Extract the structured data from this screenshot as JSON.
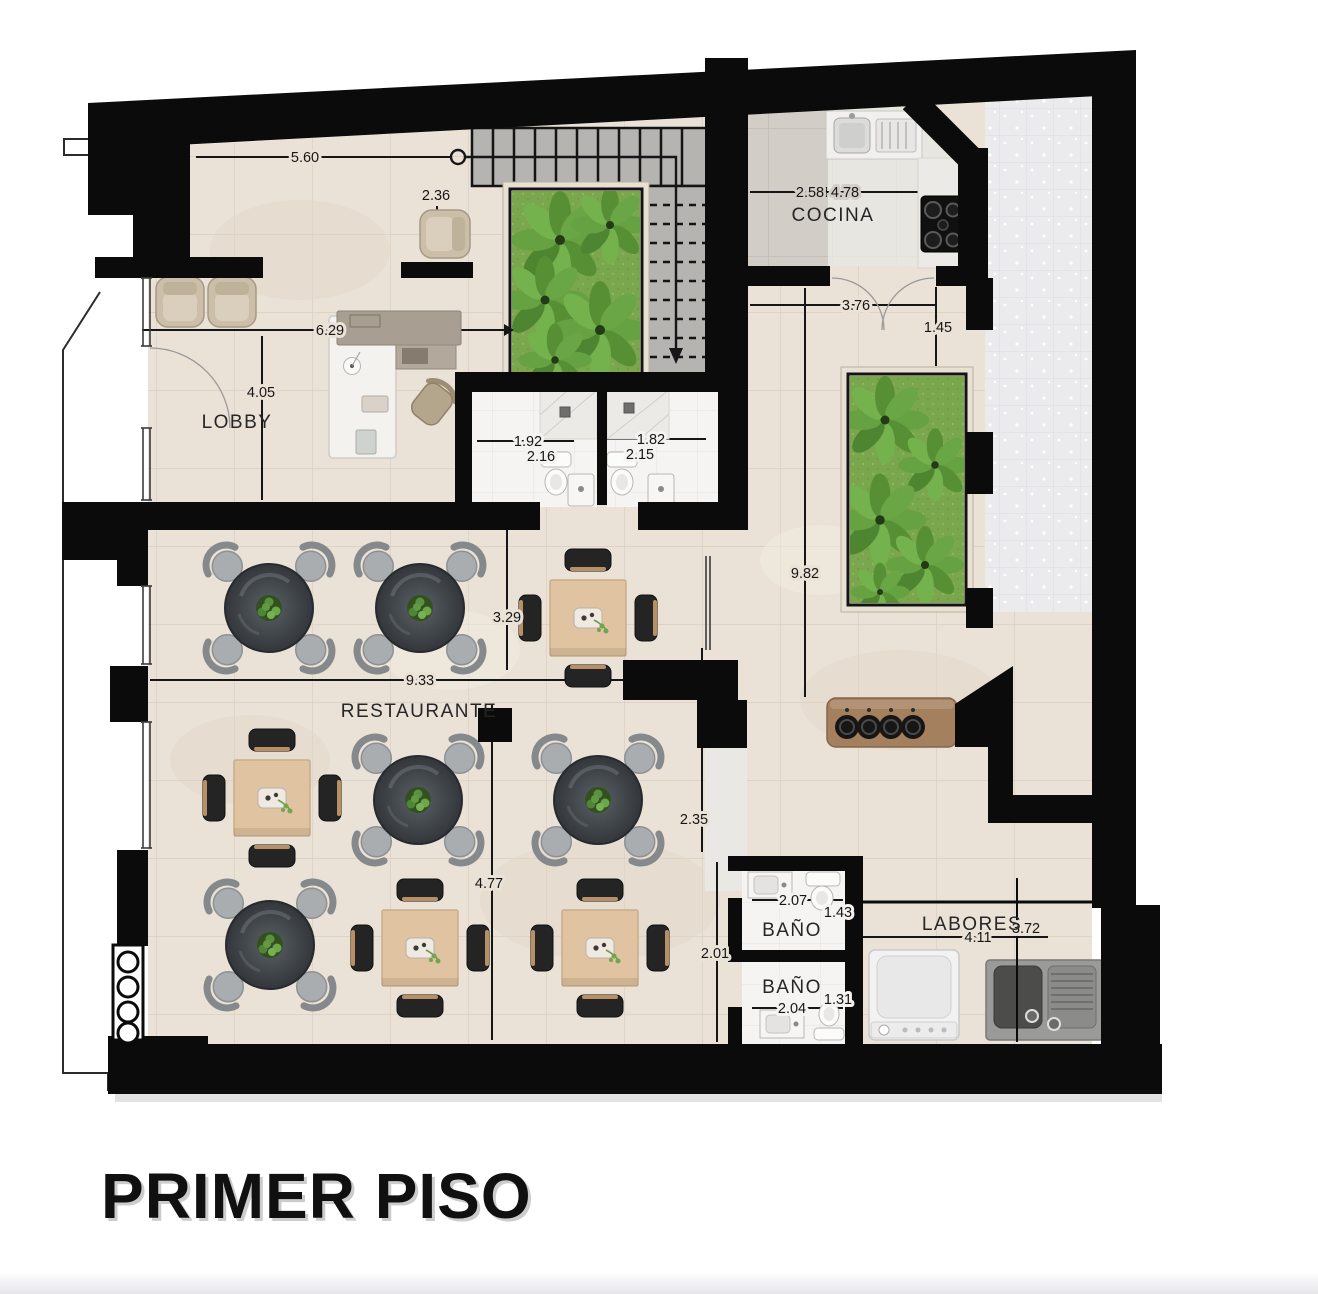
{
  "title": "PRIMER PISO",
  "rooms": {
    "lobby": "LOBBY",
    "cocina": "COCINA",
    "restaurante": "RESTAURANTE",
    "bano_1": "BAÑO",
    "bano_2": "BAÑO",
    "labores": "LABORES"
  },
  "dimensions": {
    "top_width": "5.60",
    "entry_depth": "2.36",
    "lobby_width": "6.29",
    "lobby_depth": "4.05",
    "kitchen_left": "2.58",
    "kitchen_width": "4.78",
    "kitchen_pass": "3.76",
    "planter_inset": "1.45",
    "patio_depth": "9.82",
    "bath_a_width": "1.92",
    "bath_a_depth": "2.16",
    "bath_b_width": "1.82",
    "bath_b_depth": "2.15",
    "restaurant_width": "9.33",
    "restaurant_bay": "3.29",
    "hall_width": "2.35",
    "restaurant_depth": "4.77",
    "corridor": "2.01",
    "wc_a_width": "2.07",
    "wc_a_depth": "1.43",
    "wc_b_width": "2.04",
    "wc_b_depth": "1.31",
    "labores_width": "3.72",
    "labores_span": "4.11"
  },
  "colors": {
    "wall": "#0b0b0b",
    "floor_tile": "#eae2d7",
    "kitchen_floor": "#d3cec7",
    "patio_floor": "#ebebee",
    "garden": "#7ba94e",
    "wood": "#e0c3a0",
    "bar_counter": "#a5805f",
    "table_dark": "#44494e"
  }
}
